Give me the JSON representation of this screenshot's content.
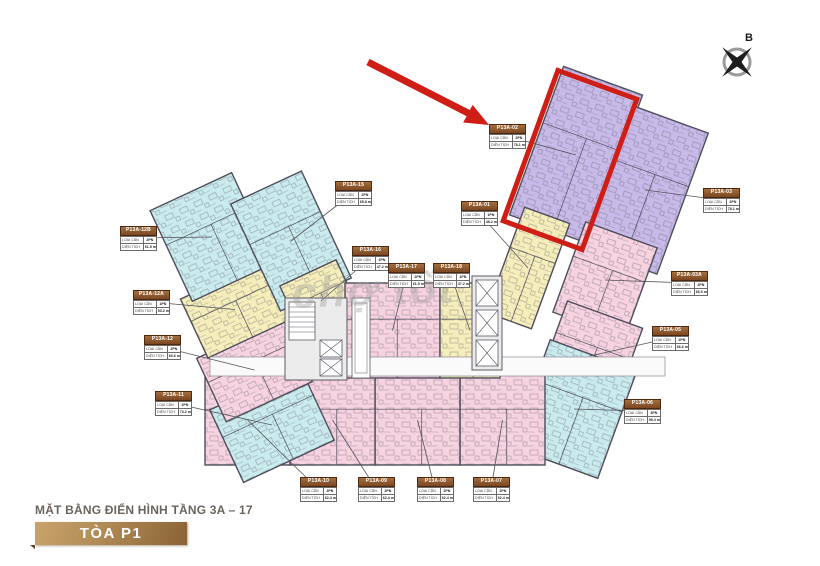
{
  "title": "MẶT BẰNG ĐIỂN HÌNH TẦNG 3A – 17",
  "tower": "TÒA P1",
  "compass": {
    "label": "B"
  },
  "watermark": "chợ tốt",
  "legend_labels": {
    "type": "LOẠI CĂN",
    "area": "DIỆN TÍCH"
  },
  "highlight": {
    "unit": "P13A-02"
  },
  "colors": {
    "cyan": "#c9ebee",
    "yellow": "#f5edba",
    "pink": "#f7d2e0",
    "purple": "#c7b9e8",
    "wall": "#4d4d5a",
    "red": "#ce1e15",
    "banner_from": "#c9a36b",
    "banner_to": "#8a6336",
    "title_text": "#6b645c",
    "watermark": "#9d9d9d"
  },
  "units": [
    {
      "id": "P13A-02",
      "type": "2PN",
      "area": "78.1 m²",
      "color": "purple",
      "highlighted": true,
      "label": {
        "x": 489,
        "y": 124
      },
      "shape": {
        "x": 534,
        "y": 76,
        "w": 84,
        "h": 158,
        "rot": 20
      }
    },
    {
      "id": "P13A-03",
      "type": "2PN",
      "area": "78.1 m²",
      "color": "purple",
      "label": {
        "x": 703,
        "y": 188
      },
      "shape": {
        "x": 605,
        "y": 115,
        "w": 80,
        "h": 150,
        "rot": 20
      }
    },
    {
      "id": "P13A-01",
      "type": "1PN",
      "area": "48.2 m²",
      "color": "yellow",
      "label": {
        "x": 461,
        "y": 201
      },
      "shape": {
        "x": 504,
        "y": 212,
        "w": 48,
        "h": 112,
        "rot": 20
      }
    },
    {
      "id": "P13A-03A",
      "type": "2PN",
      "area": "66.6 m²",
      "color": "pink",
      "label": {
        "x": 671,
        "y": 271
      },
      "shape": {
        "x": 567,
        "y": 232,
        "w": 76,
        "h": 96,
        "rot": 20
      }
    },
    {
      "id": "P13A-05",
      "type": "2PN",
      "area": "66.6 m²",
      "color": "pink",
      "label": {
        "x": 652,
        "y": 326
      },
      "shape": {
        "x": 550,
        "y": 312,
        "w": 80,
        "h": 88,
        "rot": 20
      }
    },
    {
      "id": "P13A-06",
      "type": "3PN",
      "area": "95.4 m²",
      "color": "cyan",
      "label": {
        "x": 624,
        "y": 399
      },
      "shape": {
        "x": 528,
        "y": 352,
        "w": 92,
        "h": 114,
        "rot": 20
      }
    },
    {
      "id": "P13A-07",
      "type": "2PN",
      "area": "62.4 m²",
      "color": "pink",
      "label": {
        "x": 473,
        "y": 477
      },
      "shape": {
        "x": 460,
        "y": 375,
        "w": 85,
        "h": 90,
        "rot": 0
      }
    },
    {
      "id": "P13A-08",
      "type": "2PN",
      "area": "62.4 m²",
      "color": "pink",
      "label": {
        "x": 417,
        "y": 477
      },
      "shape": {
        "x": 375,
        "y": 375,
        "w": 85,
        "h": 90,
        "rot": 0
      }
    },
    {
      "id": "P13A-09",
      "type": "2PN",
      "area": "62.4 m²",
      "color": "pink",
      "label": {
        "x": 358,
        "y": 477
      },
      "shape": {
        "x": 290,
        "y": 375,
        "w": 85,
        "h": 90,
        "rot": 0
      }
    },
    {
      "id": "P13A-10",
      "type": "2PN",
      "area": "62.4 m²",
      "color": "pink",
      "label": {
        "x": 300,
        "y": 477
      },
      "shape": {
        "x": 205,
        "y": 375,
        "w": 85,
        "h": 90,
        "rot": 0
      }
    },
    {
      "id": "P13A-11",
      "type": "2PN",
      "area": "73.2 m²",
      "color": "cyan",
      "label": {
        "x": 155,
        "y": 391
      },
      "shape": {
        "x": 222,
        "y": 385,
        "w": 100,
        "h": 80,
        "rot": -25
      }
    },
    {
      "id": "P13A-12",
      "type": "2PN",
      "area": "66.6 m²",
      "color": "pink",
      "label": {
        "x": 144,
        "y": 335
      },
      "shape": {
        "x": 207,
        "y": 335,
        "w": 95,
        "h": 70,
        "rot": -25
      }
    },
    {
      "id": "P13A-12A",
      "type": "1PN",
      "area": "53.2 m²",
      "color": "yellow",
      "label": {
        "x": 133,
        "y": 290
      },
      "shape": {
        "x": 190,
        "y": 277,
        "w": 90,
        "h": 65,
        "rot": -25
      }
    },
    {
      "id": "P13A-12B",
      "type": "2PN",
      "area": "61.5 m²",
      "color": "cyan",
      "label": {
        "x": 120,
        "y": 226
      },
      "shape": {
        "x": 167,
        "y": 187,
        "w": 90,
        "h": 100,
        "rot": -25
      }
    },
    {
      "id": "P13A-15",
      "type": "2PN",
      "area": "65.8 m²",
      "color": "cyan",
      "label": {
        "x": 335,
        "y": 181
      },
      "shape": {
        "x": 252,
        "y": 182,
        "w": 78,
        "h": 118,
        "rot": -25
      }
    },
    {
      "id": "P13A-16",
      "type": "1PN",
      "area": "47.2 m²",
      "color": "yellow",
      "label": {
        "x": 352,
        "y": 246
      },
      "shape": {
        "x": 290,
        "y": 270,
        "w": 62,
        "h": 62,
        "rot": -25
      }
    },
    {
      "id": "P13A-17",
      "type": "2PN",
      "area": "61.5 m²",
      "color": "pink",
      "label": {
        "x": 388,
        "y": 263
      },
      "shape": {
        "x": 345,
        "y": 283,
        "w": 95,
        "h": 95,
        "rot": 0
      }
    },
    {
      "id": "P13A-18",
      "type": "1PN",
      "area": "47.2 m²",
      "color": "yellow",
      "label": {
        "x": 433,
        "y": 263
      },
      "shape": {
        "x": 440,
        "y": 283,
        "w": 60,
        "h": 95,
        "rot": 0
      }
    }
  ]
}
